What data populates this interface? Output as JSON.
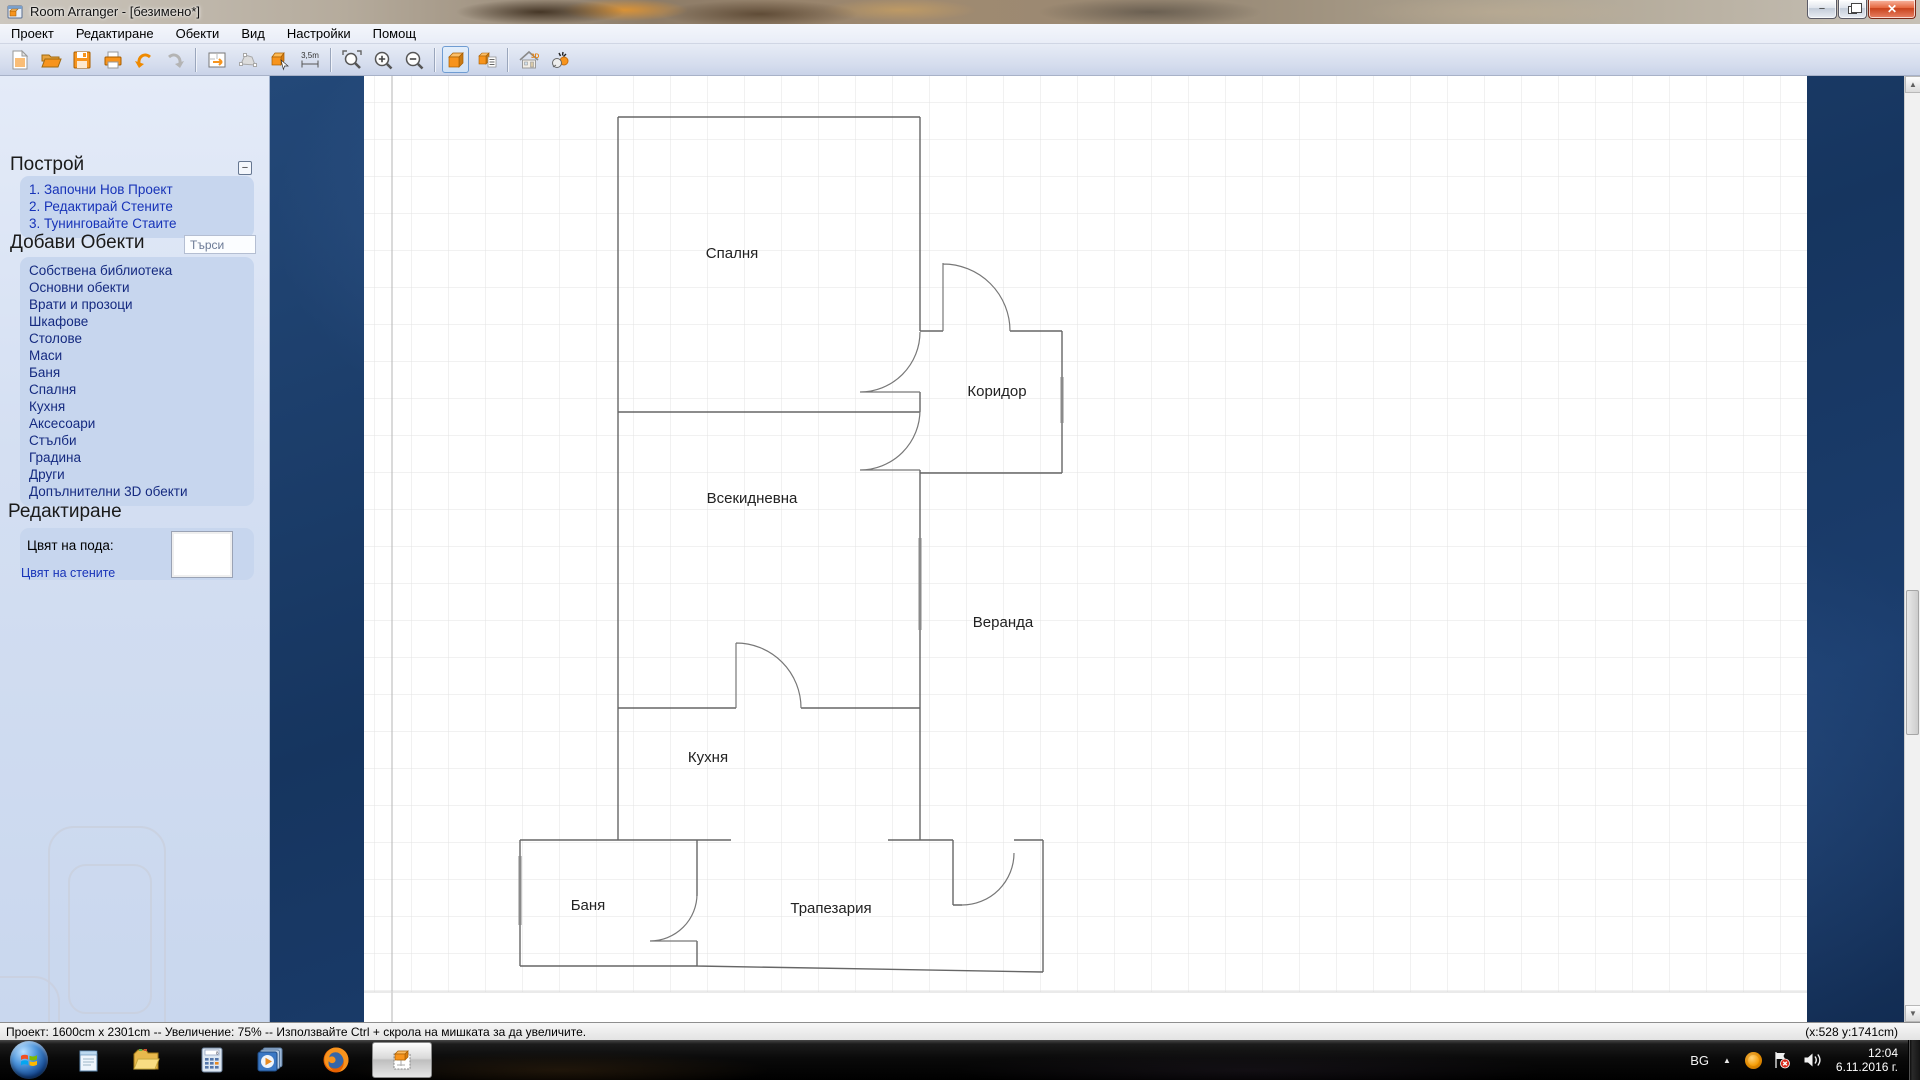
{
  "window": {
    "title": "Room Arranger - [безимено*]"
  },
  "menu": {
    "items": [
      "Проект",
      "Редактиране",
      "Обекти",
      "Вид",
      "Настройки",
      "Помощ"
    ]
  },
  "toolbar": {
    "measure_label": "3,5m"
  },
  "glyphs": {
    "collapse": "−",
    "minimize": "−",
    "close": "✕",
    "scroll_up": "▲",
    "scroll_down": "▼",
    "tray_expand": "▲"
  },
  "sidebar": {
    "build": {
      "title": "Построй",
      "items": [
        "1. Започни Нов Проект",
        "2. Редактирай Стените",
        "3. Тунинговайте Стаите"
      ]
    },
    "add_objects": {
      "title": "Добави Обекти",
      "search_placeholder": "Търси",
      "items": [
        "Собствена библиотека",
        "Основни обекти",
        "Врати и прозоци",
        "Шкафове",
        "Столове",
        "Маси",
        "Баня",
        "Спалня",
        "Кухня",
        "Аксесоари",
        "Стълби",
        "Градина",
        "Други",
        "Допълнителни 3D обекти"
      ]
    },
    "edit": {
      "title": "Редактиране",
      "floor_color_label": "Цвят на пода:",
      "floor_color": "#ffffff",
      "wall_color_link": "Цвят на стените"
    }
  },
  "canvas": {
    "rooms": [
      {
        "name": "Спалня"
      },
      {
        "name": "Коридор"
      },
      {
        "name": "Всекидневна"
      },
      {
        "name": "Веранда"
      },
      {
        "name": "Кухня"
      },
      {
        "name": "Баня"
      },
      {
        "name": "Трапезария"
      }
    ]
  },
  "status_bar": {
    "left": "Проект: 1600cm x 2301cm -- Увеличение: 75% -- Използвайте Ctrl + скрола на мишката за да увеличите.",
    "right": "(x:528 y:1741cm)"
  },
  "taskbar": {
    "tray": {
      "language": "BG",
      "time": "12:04",
      "date": "6.11.2016 г."
    }
  },
  "colors": {
    "accent_orange": "#f7941d",
    "canvas_blue": "#16355f",
    "selection_blue": "#6f9cd2"
  }
}
